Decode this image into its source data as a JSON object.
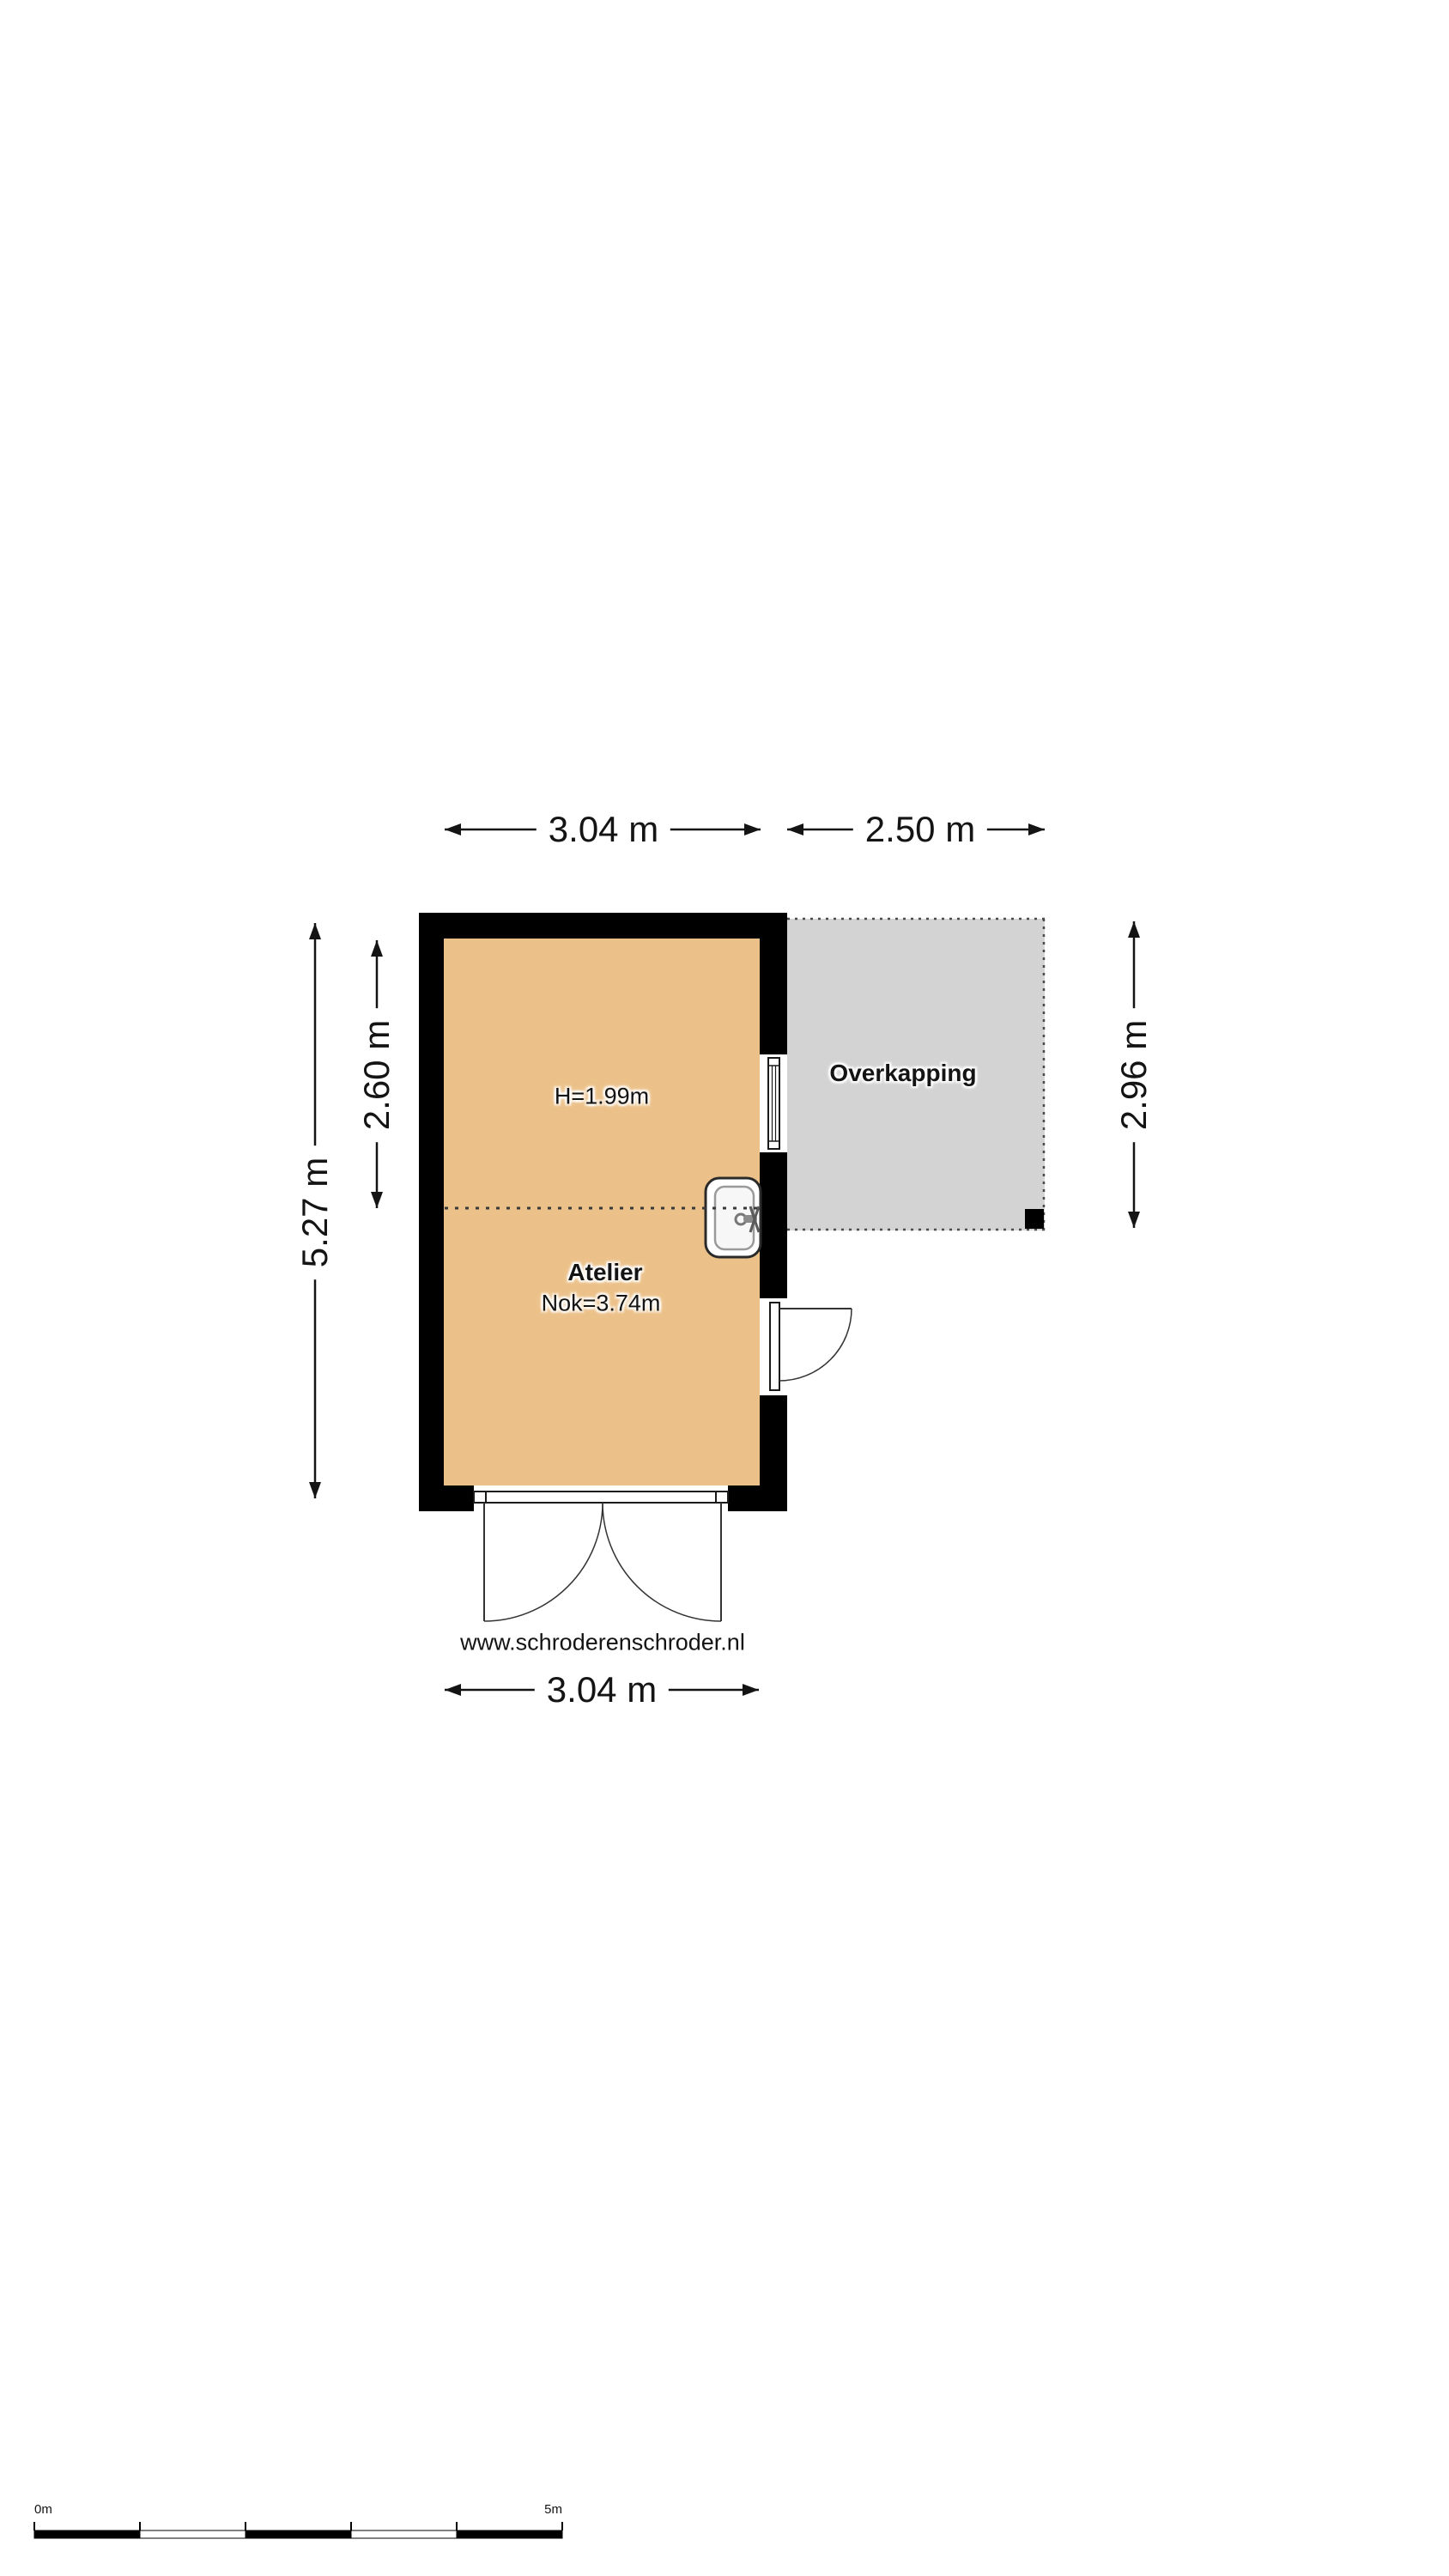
{
  "rooms": {
    "atelier": {
      "label": "Atelier",
      "ceiling_height": "H=1.99m",
      "ridge_height": "Nok=3.74m"
    },
    "canopy": {
      "label": "Overkapping"
    }
  },
  "dimensions": {
    "atelier_width_top": "3.04 m",
    "canopy_width_top": "2.50 m",
    "total_height_left": "5.27 m",
    "upper_section_height_left": "2.60 m",
    "canopy_height_right": "2.96 m",
    "atelier_width_bottom": "3.04 m"
  },
  "watermark": {
    "website": "www.schroderenschroder.nl"
  },
  "scale_bar": {
    "start": "0m",
    "end": "5m"
  },
  "colors": {
    "floor_fill": "#ecc189",
    "canopy_fill": "#d3d3d3",
    "wall": "#000000",
    "text": "#141414"
  }
}
